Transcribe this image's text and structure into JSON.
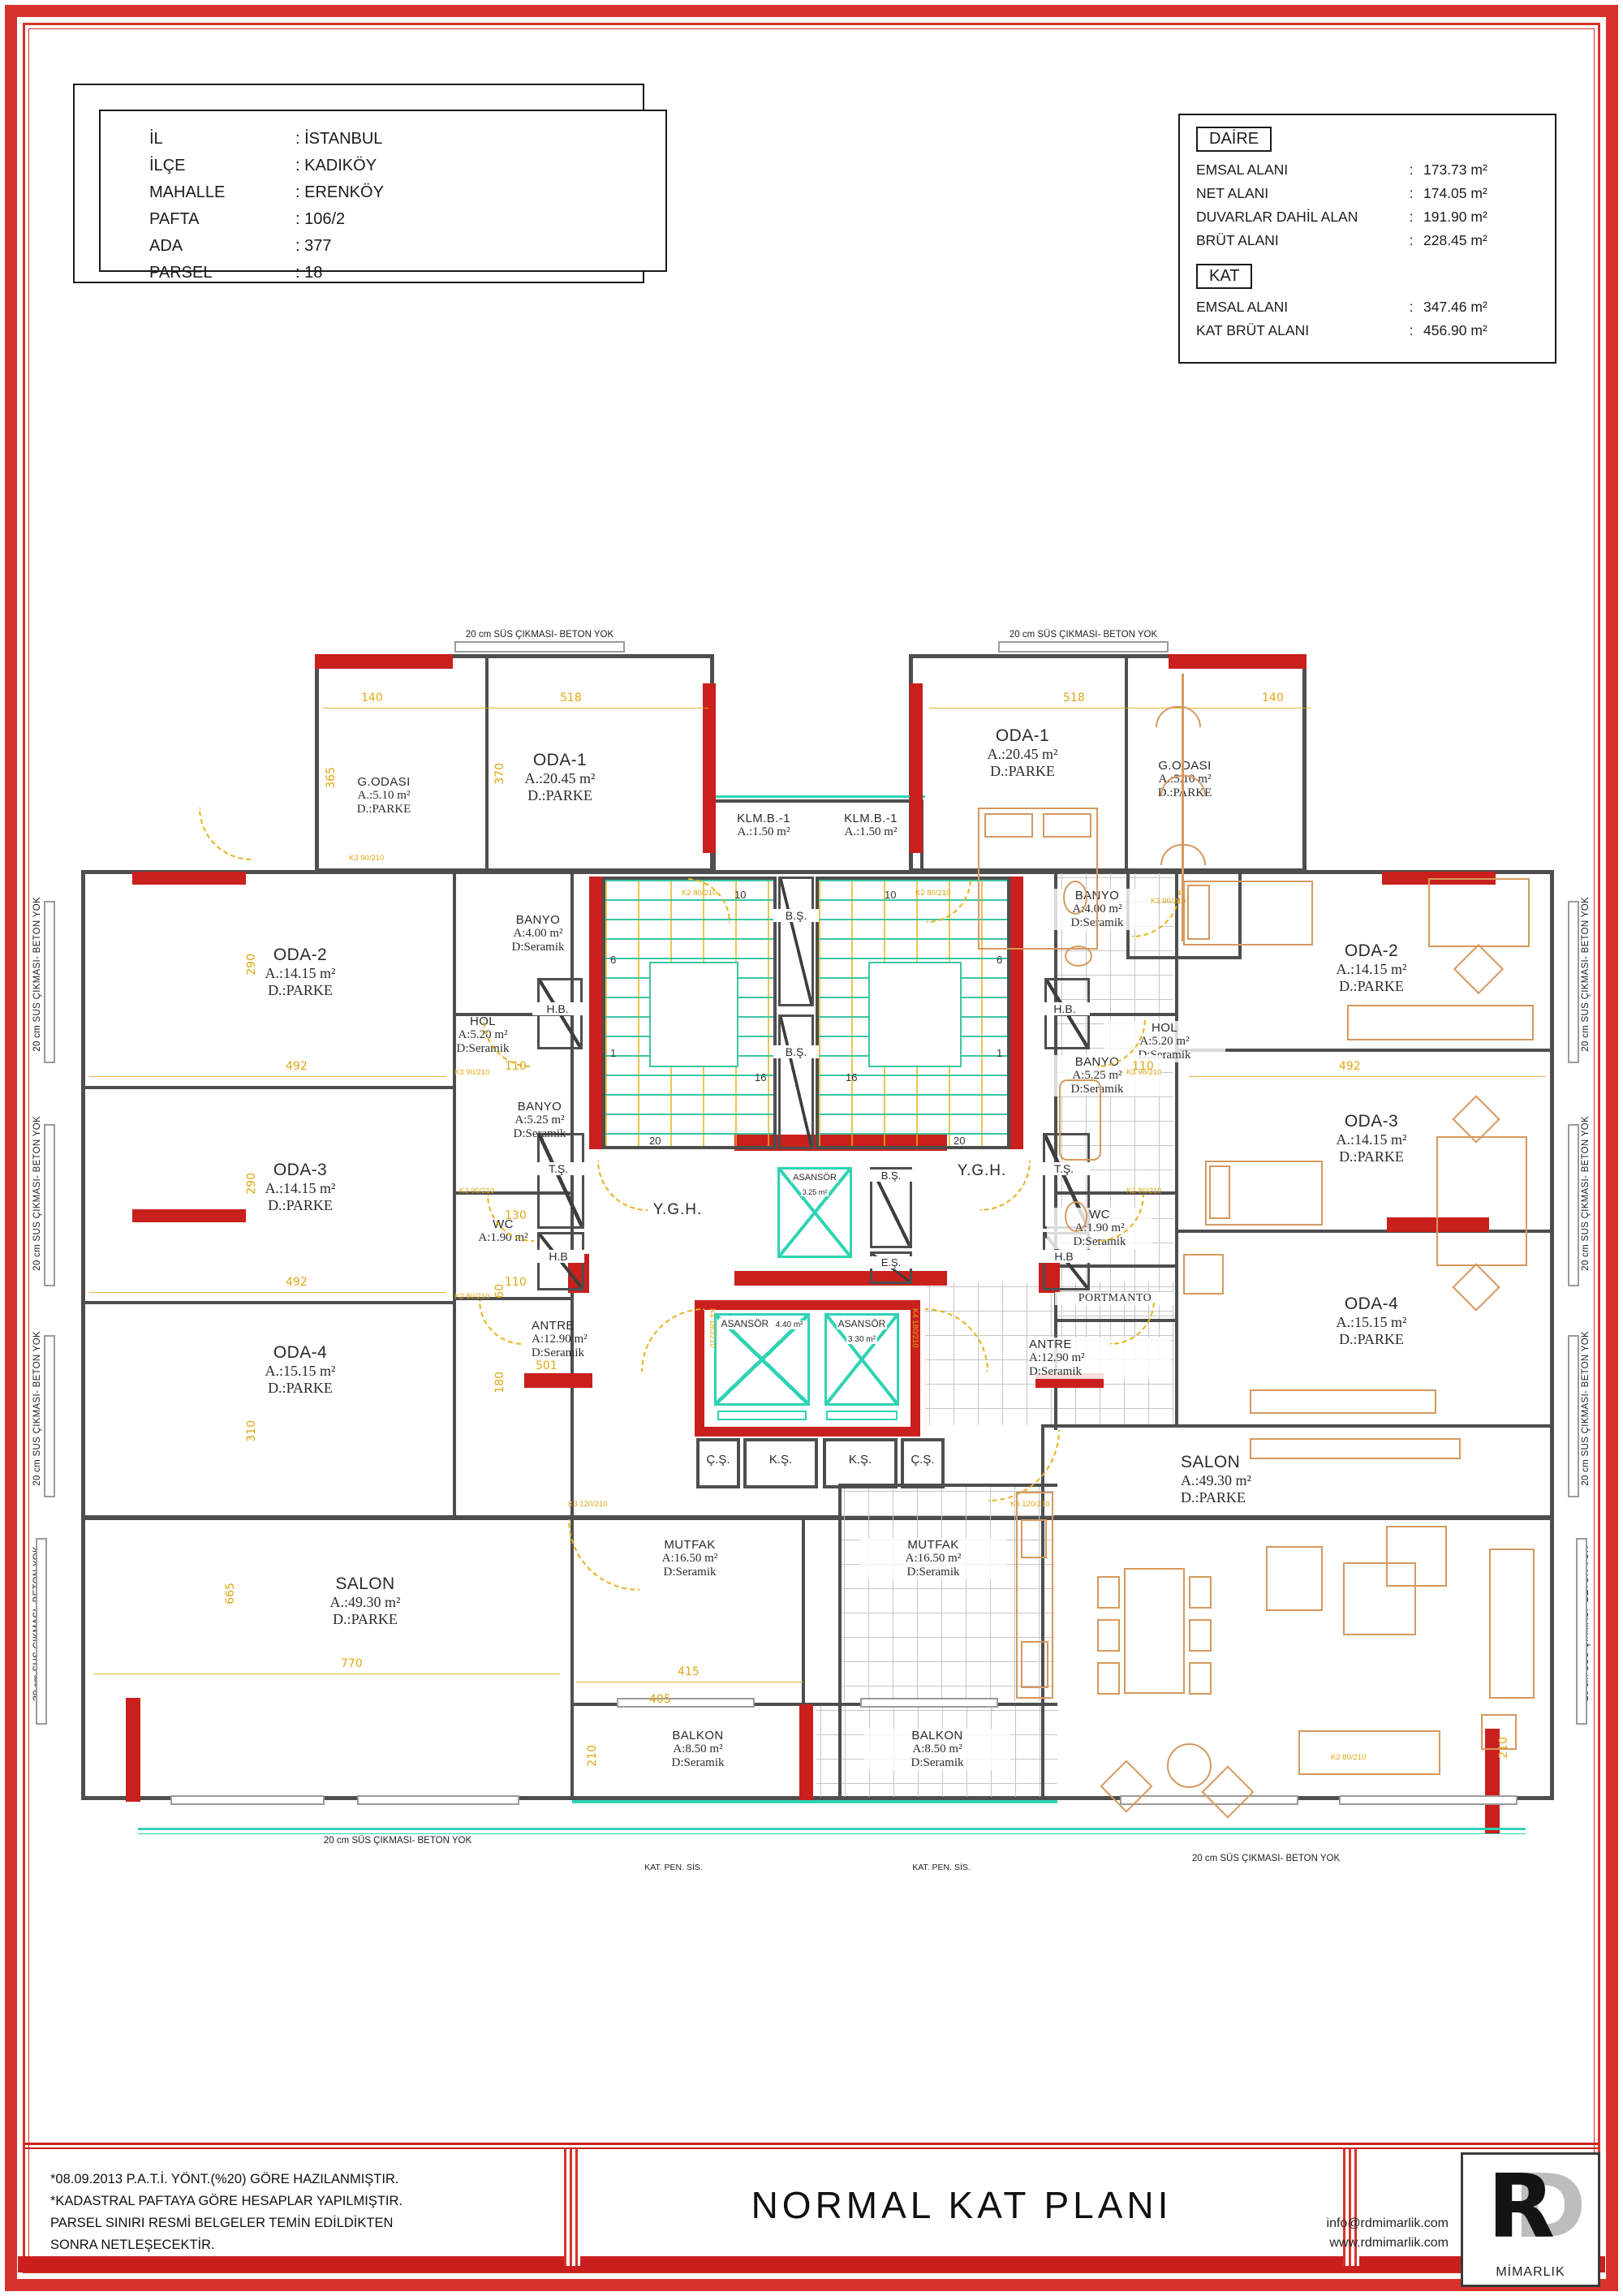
{
  "punct": {
    "colon": ":"
  },
  "location_box": {
    "rows": [
      {
        "label": "İL",
        "value": ": İSTANBUL"
      },
      {
        "label": "İLÇE",
        "value": ": KADIKÖY"
      },
      {
        "label": "MAHALLE",
        "value": ": ERENKÖY"
      },
      {
        "label": "PAFTA",
        "value": ": 106/2"
      },
      {
        "label": "ADA",
        "value": ": 377"
      },
      {
        "label": "PARSEL",
        "value": ": 18"
      }
    ]
  },
  "area_box": {
    "daire_heading": "DAİRE",
    "daire_rows": [
      {
        "label": "EMSAL ALANI",
        "value": "173.73 m²"
      },
      {
        "label": "NET ALANI",
        "value": "174.05 m²"
      },
      {
        "label": "DUVARLAR DAHİL ALAN",
        "value": "191.90 m²"
      },
      {
        "label": "BRÜT ALANI",
        "value": "228.45 m²"
      }
    ],
    "kat_heading": "KAT",
    "kat_rows": [
      {
        "label": "EMSAL ALANI",
        "value": "347.46 m²"
      },
      {
        "label": "KAT BRÜT ALANI",
        "value": "456.90 m²"
      }
    ]
  },
  "plan": {
    "edge_note": "20 cm SÜS ÇIKMASI- BETON YOK",
    "kat_pen": "KAT. PEN. SİS.",
    "rooms": [
      {
        "name": "G.ODASI",
        "area": "A.:5.10 m²",
        "floor": "D.:PARKE"
      },
      {
        "name": "ODA-1",
        "area": "A.:20.45 m²",
        "floor": "D.:PARKE"
      },
      {
        "name": "KLM.B.-1",
        "area": "A.:1.50 m²"
      },
      {
        "name": "KLM.B.-1",
        "area": "A.:1.50 m²"
      },
      {
        "name": "ODA-1",
        "area": "A.:20.45 m²",
        "floor": "D.:PARKE"
      },
      {
        "name": "G.ODASI",
        "area": "A.:5.10 m²",
        "floor": "D.:PARKE"
      },
      {
        "name": "ODA-2",
        "area": "A.:14.15 m²",
        "floor": "D.:PARKE"
      },
      {
        "name": "BANYO",
        "area": "A:4.00 m²",
        "floor": "D:Seramik"
      },
      {
        "name": "HOL",
        "area": "A:5.20 m²",
        "floor": "D:Seramik"
      },
      {
        "name": "BANYO",
        "area": "A:5.25 m²",
        "floor": "D:Seramik"
      },
      {
        "name": "ODA-3",
        "area": "A.:14.15 m²",
        "floor": "D.:PARKE"
      },
      {
        "name": "WC",
        "area": "A:1.90 m²"
      },
      {
        "name": "ODA-4",
        "area": "A.:15.15 m²",
        "floor": "D.:PARKE"
      },
      {
        "name": "ANTRE",
        "area": "A:12.90 m²",
        "floor": "D:Seramik"
      },
      {
        "name": "SALON",
        "area": "A.:49.30 m²",
        "floor": "D.:PARKE"
      },
      {
        "name": "MUTFAK",
        "area": "A:16.50 m²",
        "floor": "D:Seramik"
      },
      {
        "name": "BALKON",
        "area": "A:8.50 m²",
        "floor": "D:Seramik"
      },
      {
        "name": "ODA-2",
        "area": "A.:14.15 m²",
        "floor": "D.:PARKE"
      },
      {
        "name": "BANYO",
        "area": "A:4.00 m²",
        "floor": "D:Seramik"
      },
      {
        "name": "HOL",
        "area": "A:5.20 m²",
        "floor": "D:Seramik"
      },
      {
        "name": "BANYO",
        "area": "A:5.25 m²",
        "floor": "D:Seramik"
      },
      {
        "name": "ODA-3",
        "area": "A.:14.15 m²",
        "floor": "D.:PARKE"
      },
      {
        "name": "WC",
        "area": "A:1.90 m²",
        "floor": "D:Seramik"
      },
      {
        "name": "ODA-4",
        "area": "A.:15.15 m²",
        "floor": "D.:PARKE"
      },
      {
        "name": "ANTRE",
        "area": "A:12.90 m²",
        "floor": "D:Seramik"
      },
      {
        "name": "SALON",
        "area": "A.:49.30 m²",
        "floor": "D.:PARKE"
      },
      {
        "name": "MUTFAK",
        "area": "A:16.50 m²",
        "floor": "D:Seramik"
      },
      {
        "name": "BALKON",
        "area": "A:8.50 m²",
        "floor": "D:Seramik"
      },
      {
        "name": "PORTMANTO"
      }
    ],
    "core": {
      "bs": "B.Ş.",
      "es": "E.Ş.",
      "hb": "H.B.",
      "hb2": "H.B",
      "ts": "T.Ş.",
      "cs": "Ç.Ş.",
      "ks": "K.Ş.",
      "ygh": "Y.G.H.",
      "elevators": [
        {
          "name": "ASANSÖR",
          "area": "3.25 m²"
        },
        {
          "name": "ASANSÖR",
          "area": "4.40 m²"
        },
        {
          "name": "ASANSÖR",
          "area": "3.30 m²"
        }
      ]
    },
    "stair_numbers": [
      "1",
      "6",
      "10",
      "16",
      "20"
    ],
    "dims": [
      "140",
      "518",
      "365",
      "370",
      "290",
      "492",
      "110",
      "310",
      "180",
      "60",
      "130",
      "501",
      "415",
      "405",
      "770",
      "665",
      "210"
    ],
    "door_tags": [
      "K2 80/210",
      "K3 90/210",
      "K3 120/210",
      "K4 180/210"
    ]
  },
  "title_block": {
    "notes": "*08.09.2013 P.A.T.İ. YÖNT.(%20) GÖRE HAZILANMIŞTIR.\n*KADASTRAL PAFTAYA GÖRE HESAPLAR YAPILMIŞTIR.\n PARSEL SINIRI RESMİ BELGELER TEMİN EDİLDİKTEN\n SONRA  NETLEŞECEKTİR.",
    "title": "NORMAL  KAT PLANI",
    "contact_email": "info@rdmimarlik.com",
    "contact_web": "www.rdmimarlik.com",
    "logo_r": "R",
    "logo_d": "D",
    "logo_label": "MİMARLIK"
  },
  "colors": {
    "frame_red": "#d8332a",
    "wall_red": "#c9201d",
    "wall_gray": "#4e4e4e",
    "dim_yellow": "#dfa713",
    "stair_green": "#3cc6a2",
    "teal": "#2fd3b4",
    "furniture_orange": "#d6995f"
  }
}
